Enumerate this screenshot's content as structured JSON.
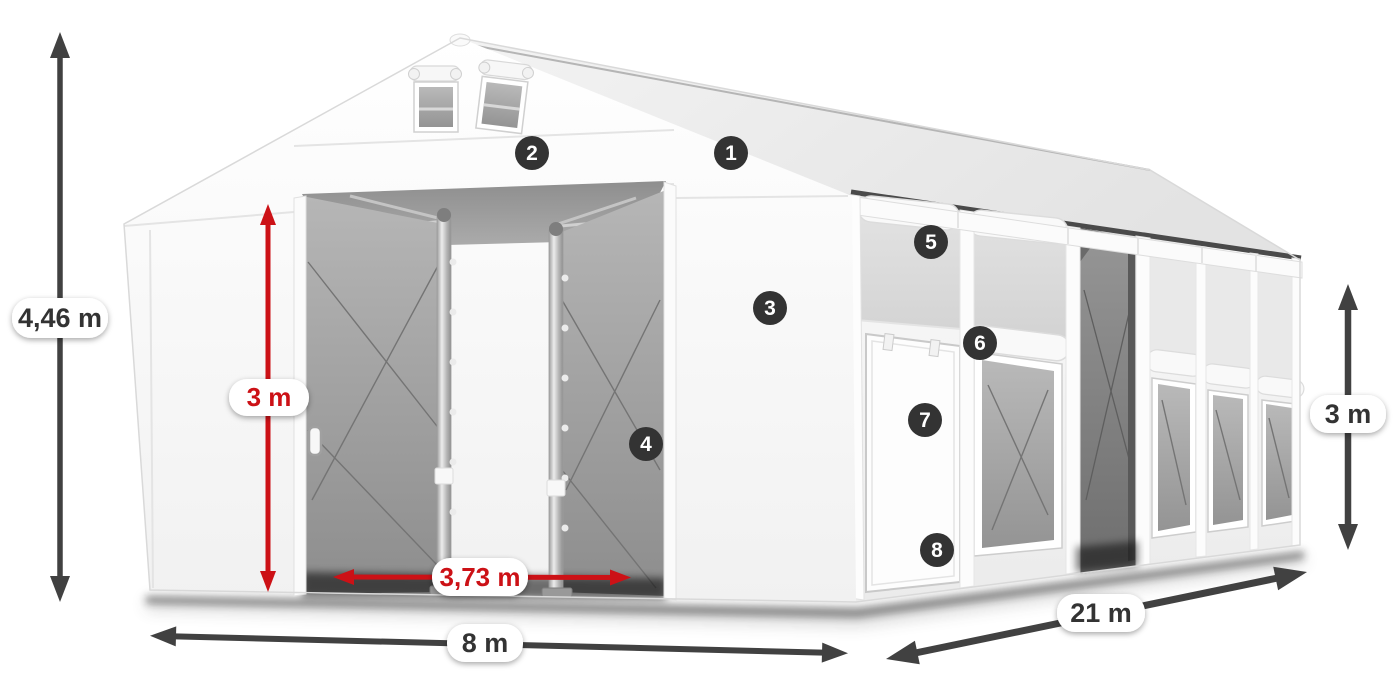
{
  "diagram": {
    "subject": "White storage tent hall with numbered feature callouts and dimension arrows",
    "dimensions": {
      "total_height": "4,46 m",
      "door_height": "3 m",
      "door_width": "3,73 m",
      "front_width": "8 m",
      "side_length": "21 m",
      "wall_height": "3 m"
    },
    "callouts": [
      "1",
      "2",
      "3",
      "4",
      "5",
      "6",
      "7",
      "8"
    ],
    "colors": {
      "highlight_red": "#cc1116",
      "dimension_gray": "#414141",
      "callout_bg": "#333333",
      "callout_text": "#ffffff",
      "label_bg": "#ffffff",
      "label_text": "#333333"
    }
  }
}
